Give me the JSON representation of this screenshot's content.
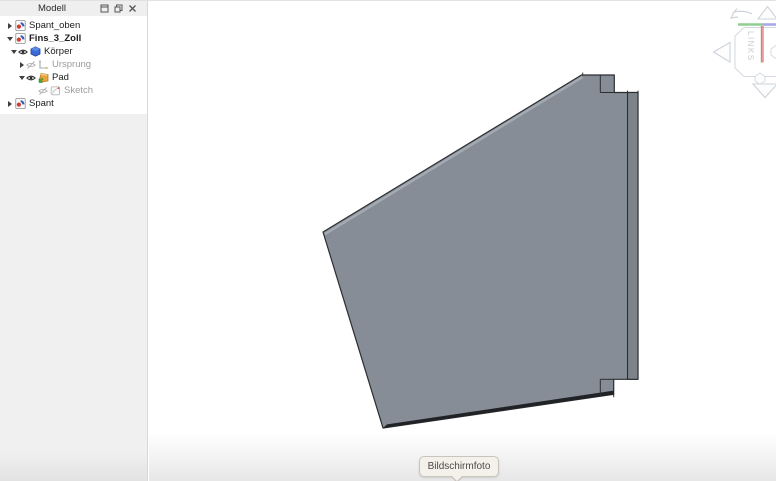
{
  "panel": {
    "title": "Modell",
    "window_controls": {
      "dock": "dock",
      "float": "float",
      "close": "close"
    },
    "tree": {
      "items": [
        {
          "label": "Spant_oben",
          "depth": 0,
          "state": "collapsed",
          "icon": "freecad-document",
          "bold": false,
          "grayed": false
        },
        {
          "label": "Fins_3_Zoll",
          "depth": 0,
          "state": "expanded",
          "icon": "freecad-document",
          "bold": true,
          "grayed": false
        },
        {
          "label": "Körper",
          "depth": 1,
          "state": "expanded",
          "icon": "partdesign-body",
          "visibility": "visible",
          "bold": false,
          "grayed": false
        },
        {
          "label": "Ursprung",
          "depth": 2,
          "state": "collapsed",
          "icon": "origin-axes",
          "visibility": "hidden",
          "bold": false,
          "grayed": true
        },
        {
          "label": "Pad",
          "depth": 2,
          "state": "expanded",
          "icon": "pad-feature",
          "visibility": "visible",
          "bold": false,
          "grayed": false
        },
        {
          "label": "Sketch",
          "depth": 3,
          "state": "leaf",
          "icon": "sketch",
          "visibility": "hidden",
          "bold": false,
          "grayed": true
        },
        {
          "label": "Spant",
          "depth": 0,
          "state": "collapsed",
          "icon": "freecad-document",
          "bold": false,
          "grayed": false
        }
      ]
    }
  },
  "viewport": {
    "part": {
      "name": "fin-solid",
      "face_color": "#878d96",
      "spar_color": "#7d838b",
      "edge_color": "#2b2d31",
      "bottom_shade_color": "#202226",
      "top_edge_highlight_color": "#a4aab2"
    },
    "nav_cube": {
      "face_label": "LINKS",
      "axis_colors": {
        "x": "#8fce8f",
        "y": "#a9a9ea",
        "z": "#e07a7a"
      }
    },
    "tooltip": {
      "label": "Bildschirmfoto"
    }
  }
}
